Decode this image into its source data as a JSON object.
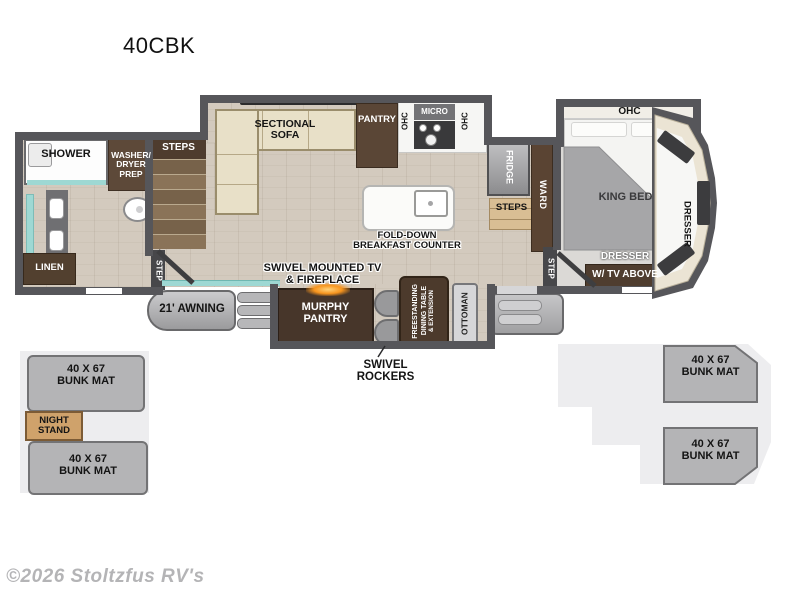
{
  "title": "40CBK",
  "watermark": "©2026 Stoltzfus RV's",
  "labels": {
    "shower": "SHOWER",
    "washer_dryer": [
      "WASHER/",
      "DRYER",
      "PREP"
    ],
    "steps_bath": "STEPS",
    "step_bath": "STEP",
    "linen": "LINEN",
    "sectional_sofa": [
      "SECTIONAL",
      "SOFA"
    ],
    "pantry": "PANTRY",
    "ohc_left": "OHC",
    "micro": "MICRO",
    "ohc_right": "OHC",
    "island": [
      "FOLD-DOWN",
      "BREAKFAST COUNTER"
    ],
    "fridge": "FRIDGE",
    "steps_kitchen": "STEPS",
    "ward": "WARD",
    "ohc_bedroom": "OHC",
    "king_bed": "KING BED",
    "step_bedroom": "STEP",
    "dresser_tv": [
      "DRESSER",
      "W/ TV ABOVE"
    ],
    "dresser_cap": "DRESSER",
    "awning": "21' AWNING",
    "tv_fireplace": [
      "SWIVEL MOUNTED TV",
      "& FIREPLACE"
    ],
    "murphy_pantry": [
      "MURPHY",
      "PANTRY"
    ],
    "swivel_rockers": [
      "SWIVEL",
      "ROCKERS"
    ],
    "dining_table": [
      "FREESTANDING",
      "DINING TABLE",
      "& EXTENSION"
    ],
    "ottoman": "OTTOMAN",
    "bunk_left_top": [
      "40 X 67",
      "BUNK MAT"
    ],
    "night_stand": [
      "NIGHT",
      "STAND"
    ],
    "bunk_left_bottom": [
      "40 X 67",
      "BUNK MAT"
    ],
    "bunk_right_top": [
      "40 X 67",
      "BUNK MAT"
    ],
    "bunk_right_bottom": [
      "40 X 67",
      "BUNK MAT"
    ]
  },
  "colors": {
    "wall_gray": "#56565a",
    "dark_wood_cabinet": "#4c3a2c",
    "medium_wood_steps": "#77624a",
    "sofa_cream": "#e8e0c8",
    "teal_glass": "#9ed8d3",
    "flame_orange": "#f7941d",
    "bunk_mat_gray": "#b4b4b6",
    "backdrop_gray": "#ededef",
    "night_stand_tan": "#cfa26b"
  }
}
